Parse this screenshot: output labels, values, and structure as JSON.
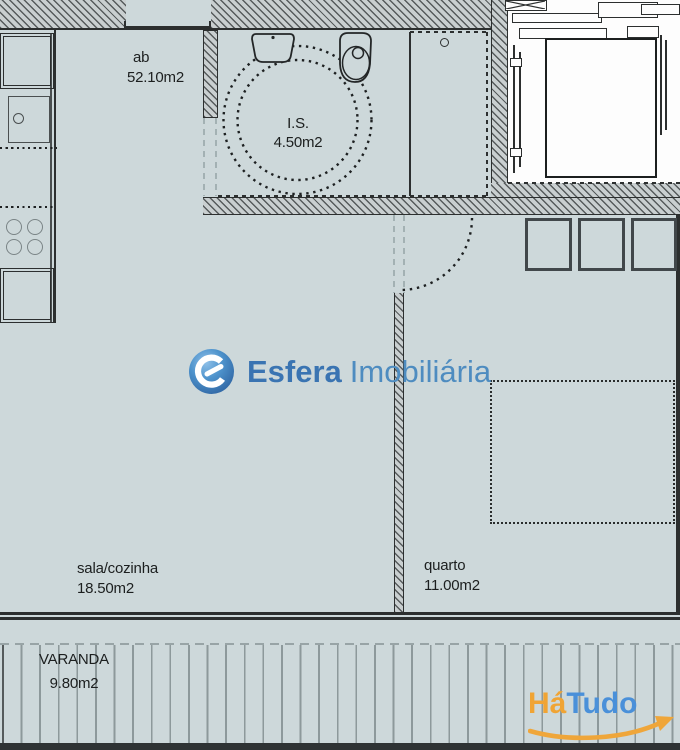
{
  "plan_title": "Apartment floor plan",
  "rooms": {
    "total": {
      "name": "ab",
      "area": "52.10m2"
    },
    "bath": {
      "name": "I.S.",
      "area": "4.50m2"
    },
    "living": {
      "name": "sala/cozinha",
      "area": "18.50m2"
    },
    "bedroom": {
      "name": "quarto",
      "area": "11.00m2"
    },
    "balcony": {
      "name": "VARANDA",
      "area": "9.80m2"
    }
  },
  "watermarks": {
    "esfera": {
      "brand": "Esfera",
      "suffix": "Imobiliária",
      "brand_color": "#3a74b2",
      "suffix_color": "#4e8cc0",
      "sphere_colors": [
        "#8fc0e8",
        "#4e93cc",
        "#2d62a0"
      ]
    },
    "hatudo": {
      "part1": "Há",
      "part2": "Tudo",
      "part1_color": "#f0a434",
      "part2_color": "#4a90d9",
      "swoosh_color": "#efa63a"
    }
  },
  "colors": {
    "floor_fill": "#cdd8da",
    "wall_hatch_line": "#565b5c",
    "wall_hatch_fill": "#c9cfd0",
    "drawing_line": "#2c2f2f",
    "deck_line": "#8d999b",
    "elevator_fill": "#fdfdfd"
  },
  "icons": {
    "kitchen": [
      "fridge-icon",
      "kitchen-sink-icon",
      "stove-burners-icon",
      "oven-icon"
    ],
    "bathroom": [
      "washbasin-icon",
      "toilet-icon",
      "turning-circle-icon"
    ],
    "other": [
      "elevator-icon",
      "wardrobe-icon",
      "bed-outline-icon",
      "door-swing-icon"
    ]
  }
}
